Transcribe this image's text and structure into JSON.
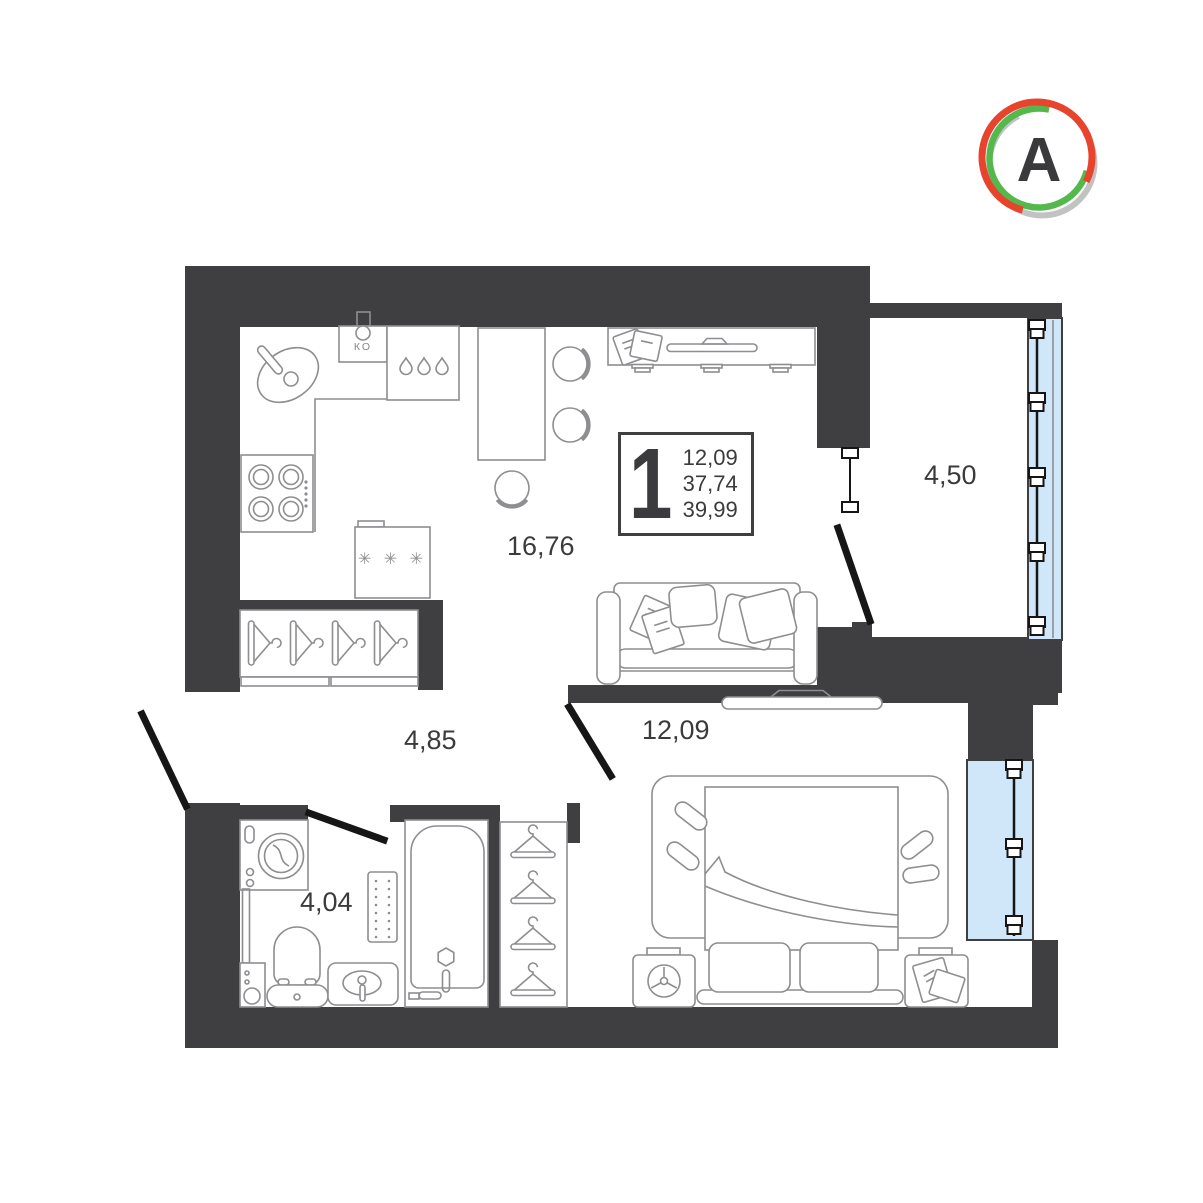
{
  "logo": {
    "letter": "A",
    "ring_colors": [
      "#e8432c",
      "#54b84c",
      "#c2c2c2"
    ],
    "letter_color": "#3a3a3c"
  },
  "info_box": {
    "rooms_count": "1",
    "areas": [
      "12,09",
      "37,74",
      "39,99"
    ]
  },
  "room_labels": {
    "kitchen_living": "16,76",
    "balcony": "4,50",
    "hallway": "4,85",
    "bedroom": "12,09",
    "bathroom": "4,04"
  },
  "annotations": {
    "vent": "КО",
    "fridge": "✳ ✳ ✳"
  },
  "colors": {
    "wall": "#3f3f41",
    "furniture_outline": "#8e8e91",
    "door": "#161616",
    "window_glass": "#cfe7f8",
    "text": "#3b3b3d",
    "background": "#ffffff"
  }
}
